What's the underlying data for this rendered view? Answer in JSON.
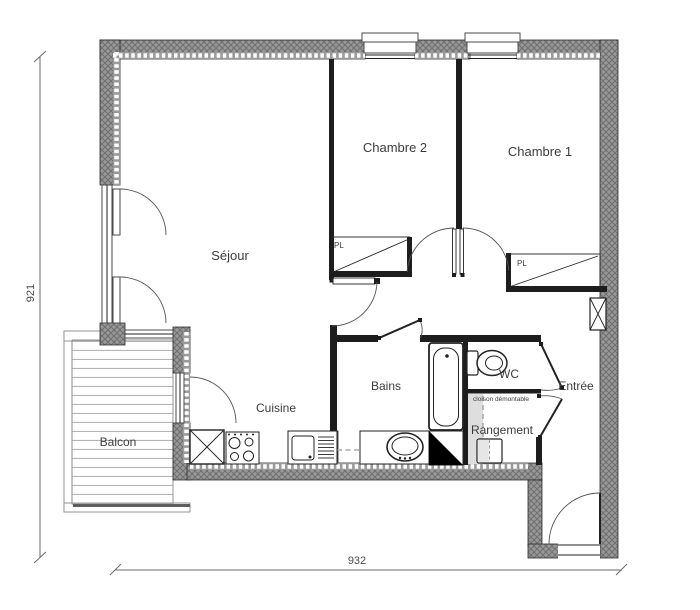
{
  "plan": {
    "rooms": {
      "sejour": "Séjour",
      "chambre2": "Chambre 2",
      "chambre1": "Chambre 1",
      "cuisine": "Cuisine",
      "bains": "Bains",
      "wc": "WC",
      "entree": "Entrée",
      "rangement": "Rangement",
      "balcon": "Balcon"
    },
    "closets": {
      "pl1": "PL",
      "pl2": "PL"
    },
    "annotations": {
      "partition": "cloison démontable"
    },
    "dimensions": {
      "height": "921",
      "width": "932"
    },
    "colors": {
      "wall_gray": "#989898",
      "hatch_line": "#6e6e6e",
      "ink": "#222222",
      "arc": "#555555"
    }
  }
}
